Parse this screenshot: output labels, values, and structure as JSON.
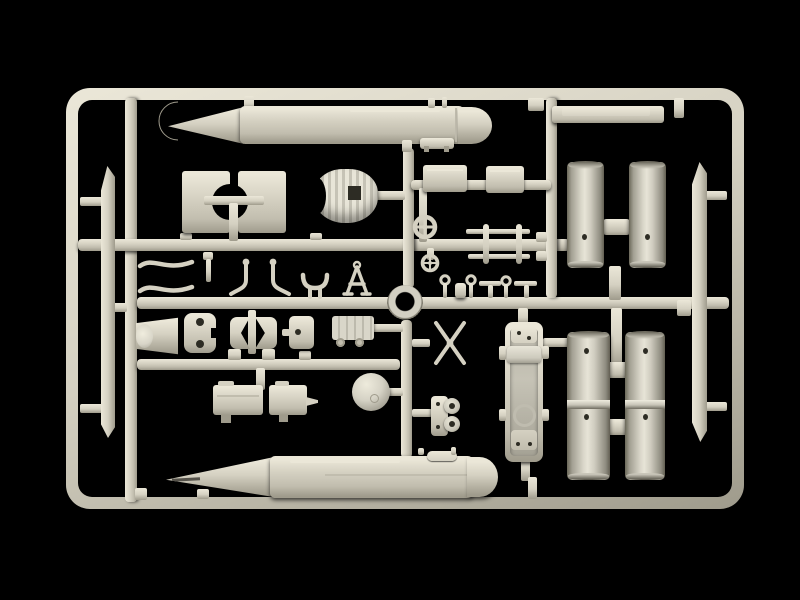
{
  "scene": {
    "description": "Photograph of a light grey injection-moulded model-kit sprue (runner frame) full of unpainted plastic parts, lit from above on a plain black background",
    "colors": {
      "bg": "#000000",
      "hl": "#ebe7d8",
      "base": "#d5d1c2",
      "mid": "#c1bdae",
      "sh": "#9f9b8c",
      "deep": "#6e6a5c",
      "hole": "#2d2c24"
    },
    "parts": {
      "sprue_frame": "rectangular sprue runner frame",
      "torpedo_upper": "large torpedo-shaped hull half (top of sprue)",
      "torpedo_lower": "large torpedo-shaped hull half (bottom of sprue)",
      "nose_crescent": "crescent nose cap ring",
      "bracket_pair": "mirrored saddle bracket plates with round cut-outs",
      "ribbed_shell": "ribbed dome intake shell with square opening",
      "equipment_box_a": "small rectangular equipment box",
      "equipment_box_b": "small rectangular equipment box",
      "flat_bar": "long flat panel bar (top right)",
      "handwheel_large": "large valve handwheel",
      "handwheel_small": "small valve handwheel",
      "railing": "twin-rail railing with stanchions",
      "ring_seal": "circular ring / collar part",
      "hose_pair": "pair of S-curved hoses",
      "small_fittings": "row of small pins, eyelets and fittings",
      "bucket": "tapered drum / bucket part",
      "hinge_plate": "hinge plate with two bosses",
      "clamshell_pair": "mirrored clamshell fairing halves",
      "hatch_door": "small hatch door with hinge pin",
      "cart": "ribbed cart with small wheels",
      "pump_box_a": "pump housing box",
      "pump_box_b": "pump housing box with spout",
      "sphere": "spherical tank / sonar ball",
      "boss_mount": "mount with twin round bosses",
      "x_propeller": "X-shaped contra propeller blades",
      "sdv_tray": "long open vehicle hull tray with saddle and hatch",
      "tube_up_left": "launch tube half (upper left)",
      "tube_up_right": "launch tube half (upper right)",
      "tube_low_left": "launch tube half (lower left)",
      "tube_low_right": "launch tube half (lower right)",
      "blade_left": "long thin stabilizer blade (left)",
      "blade_right": "long thin stabilizer blade (right)"
    }
  }
}
